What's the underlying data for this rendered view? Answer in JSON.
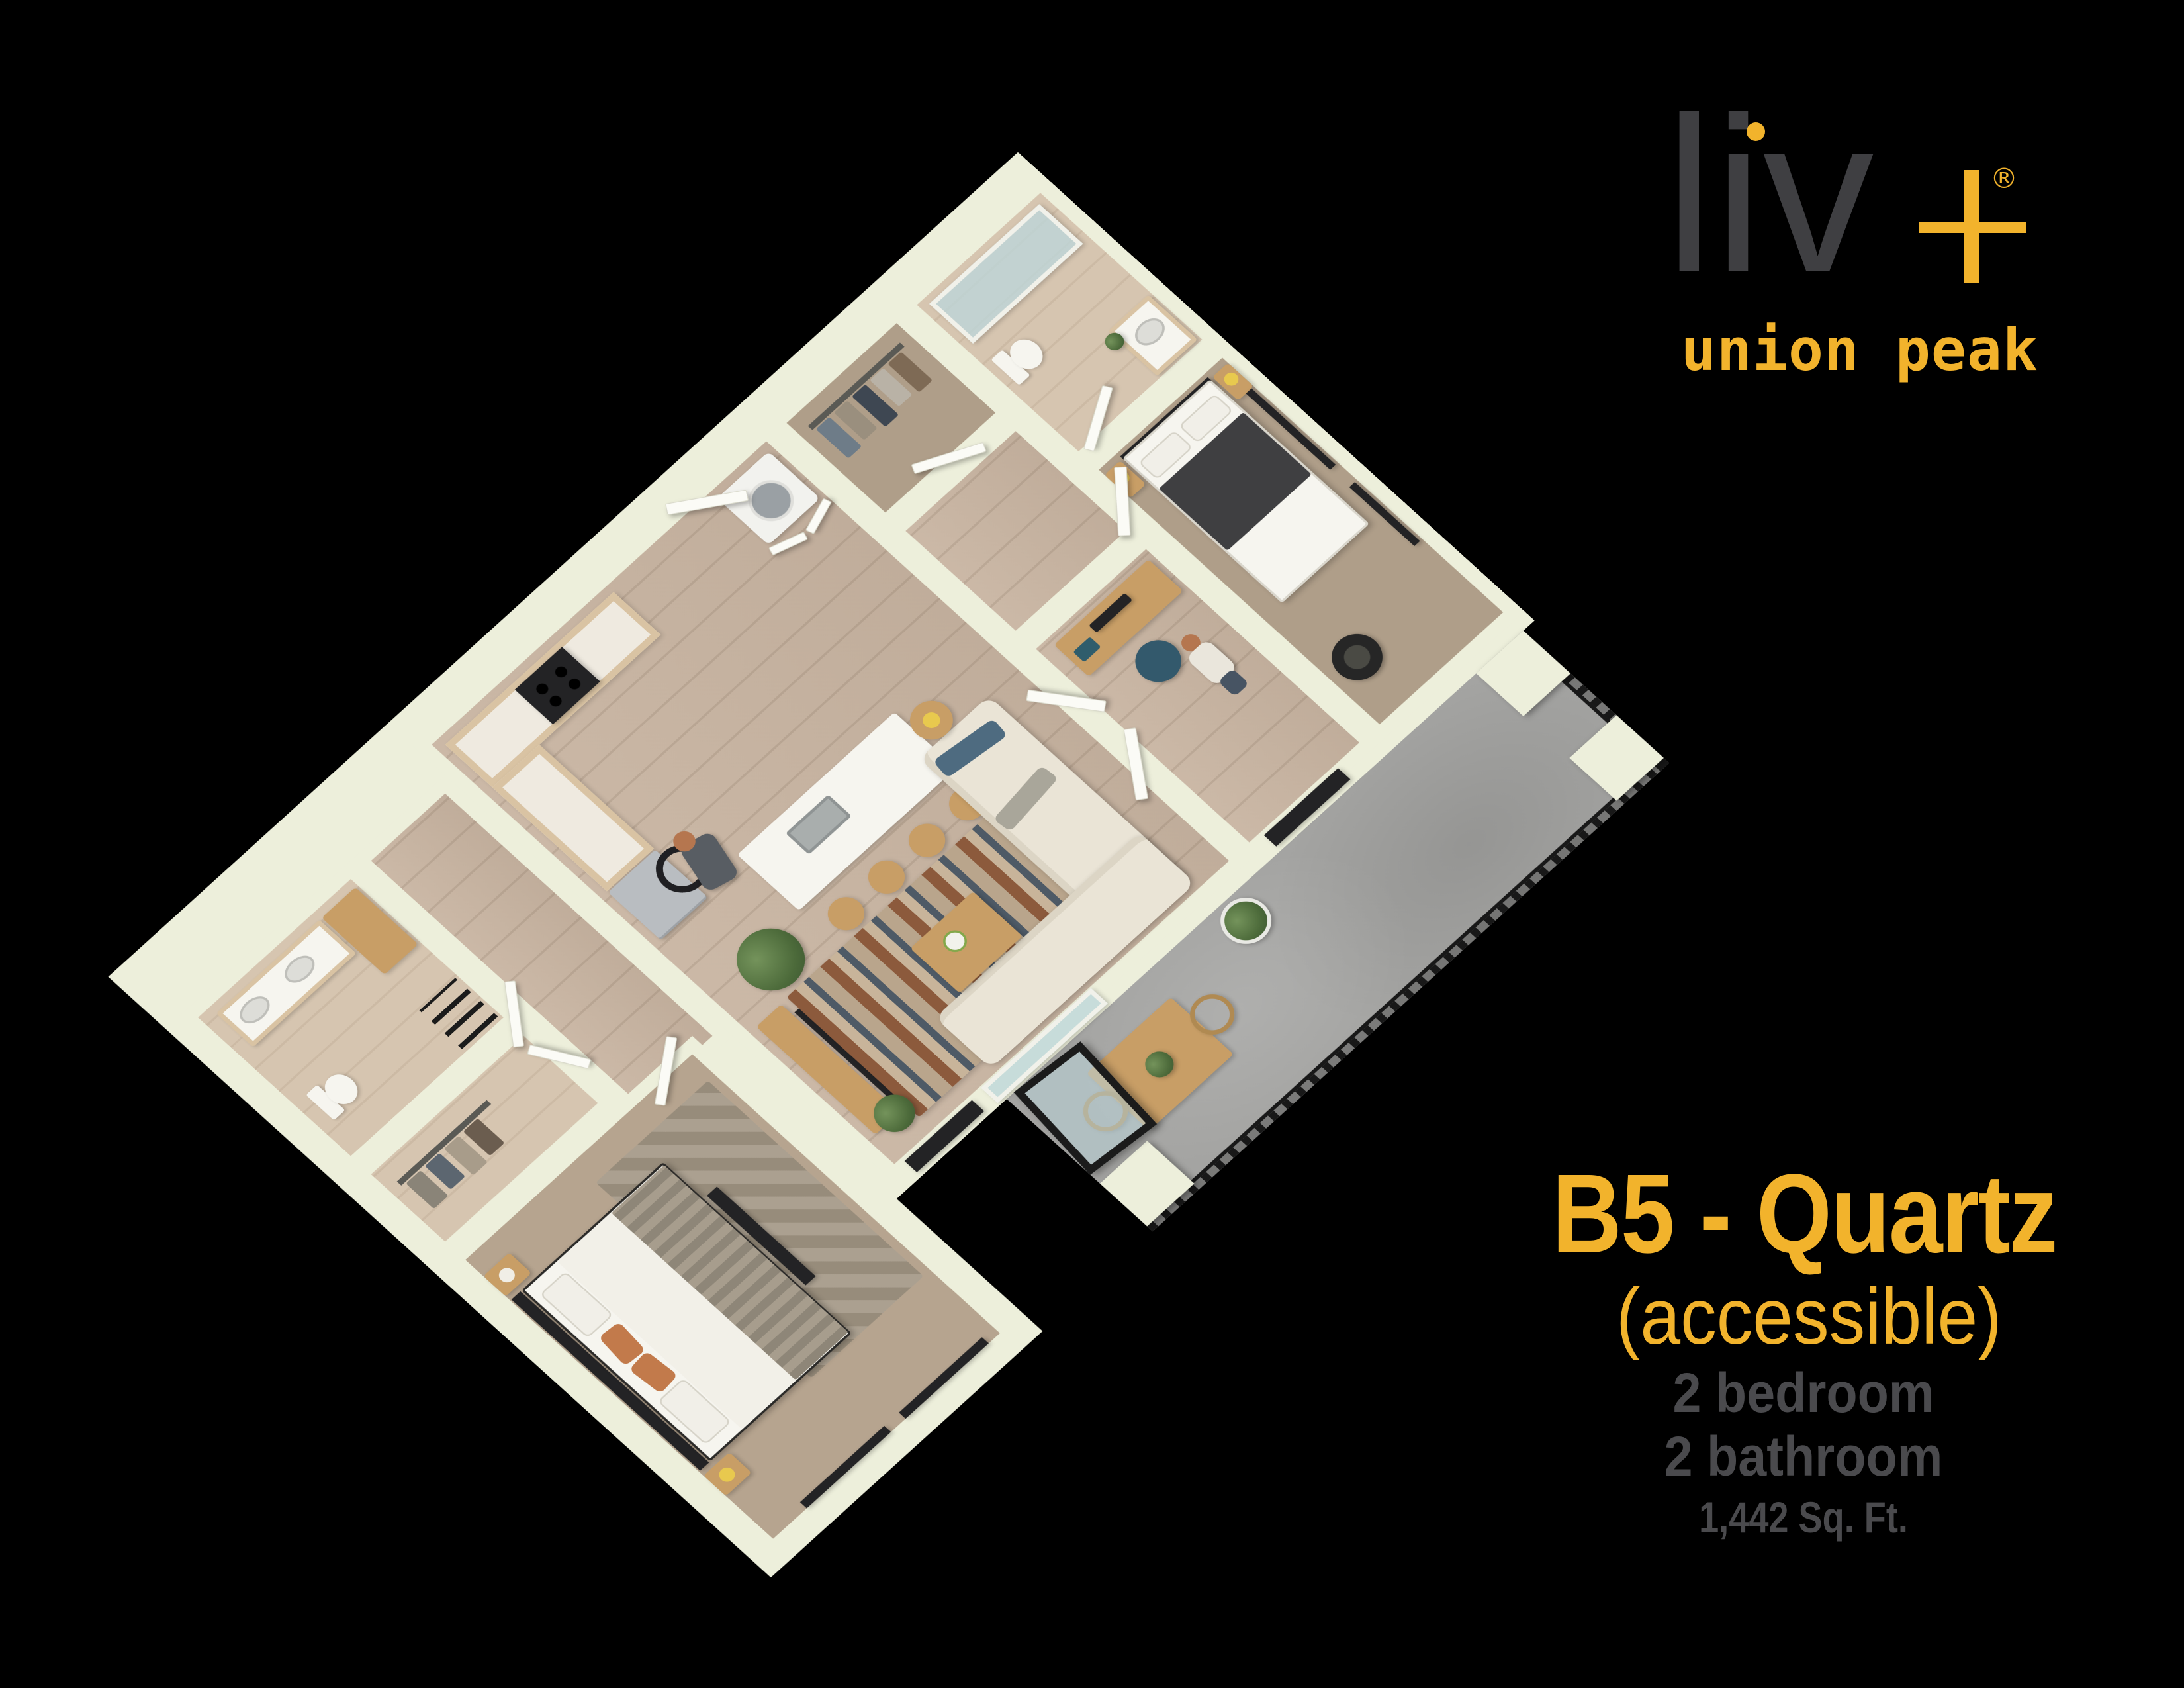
{
  "palette": {
    "accent": "#F2B32C",
    "logogray": "#3F3F42",
    "infogray": "#4A4A4D",
    "bg": "#000000",
    "wall": "#EDEFDB",
    "wood": "#C8B4A1",
    "carpet1": "#B6A48F",
    "carpet2": "#AF9E89",
    "tile": "#D6C5B0",
    "concrete": "#A4A4A2",
    "fwood": "#C89E66",
    "sofa": "#EAE4D6",
    "white": "#F6F5EF",
    "dark": "#232325",
    "glass": "#BCD5DA",
    "rail": "#181818",
    "green": "#5F7F49"
  },
  "logo": {
    "word": "liv",
    "registered": "®",
    "subtitle": "union peak"
  },
  "unit": {
    "title": "B5 - Quartz",
    "subtitle": "(accessible)",
    "specs": [
      "2 bedroom",
      "2 bathroom",
      "1,442 Sq. Ft."
    ]
  },
  "floor_plan": {
    "view": "3d-isometric-render",
    "rooms": [
      "kitchen",
      "living room",
      "bedroom 1",
      "bedroom 2",
      "bathroom 1",
      "bathroom 2",
      "walk-in closet 1",
      "walk-in closet 2",
      "den office",
      "laundry closet",
      "entry hall",
      "patio"
    ],
    "occupants": [
      "person using wheelchair in living room",
      "person standing in den office"
    ]
  }
}
